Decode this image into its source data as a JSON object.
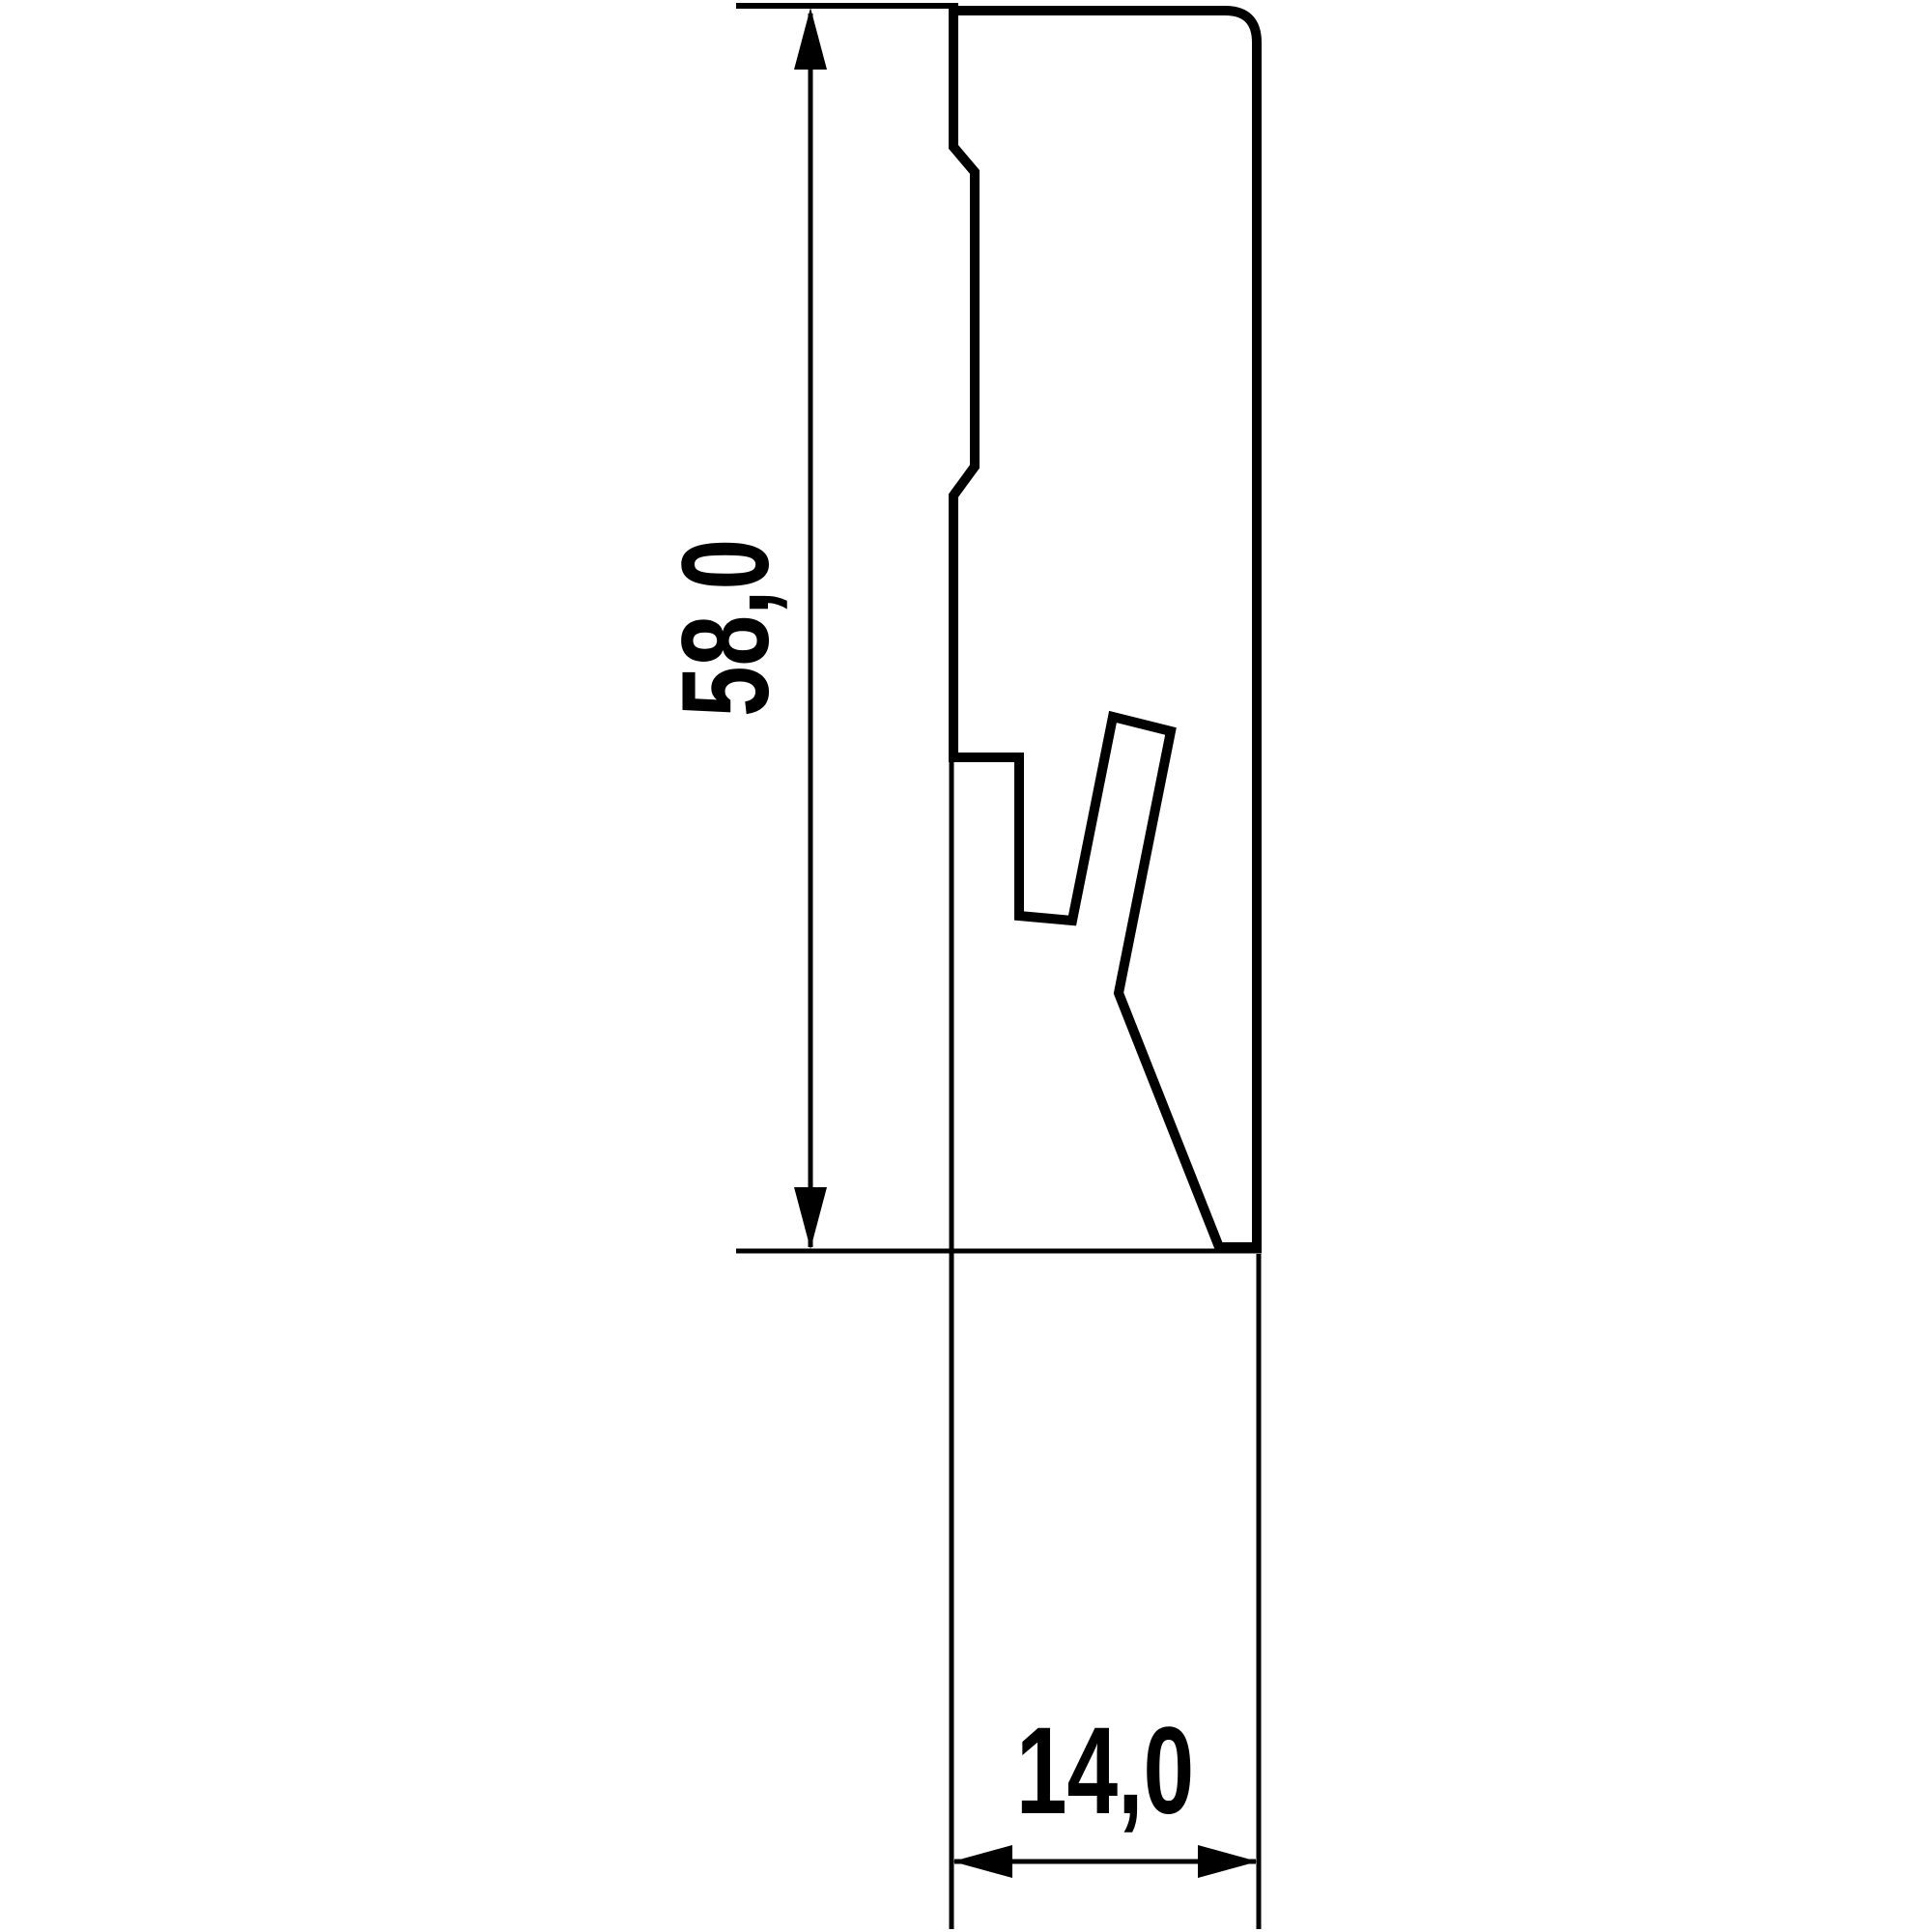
{
  "diagram": {
    "background_color": "#ffffff",
    "line_color": "#000000",
    "height_dimension": {
      "label": "58,0",
      "value_mm": 58.0,
      "orientation": "vertical"
    },
    "width_dimension": {
      "label": "14,0",
      "value_mm": 14.0,
      "orientation": "horizontal"
    }
  }
}
